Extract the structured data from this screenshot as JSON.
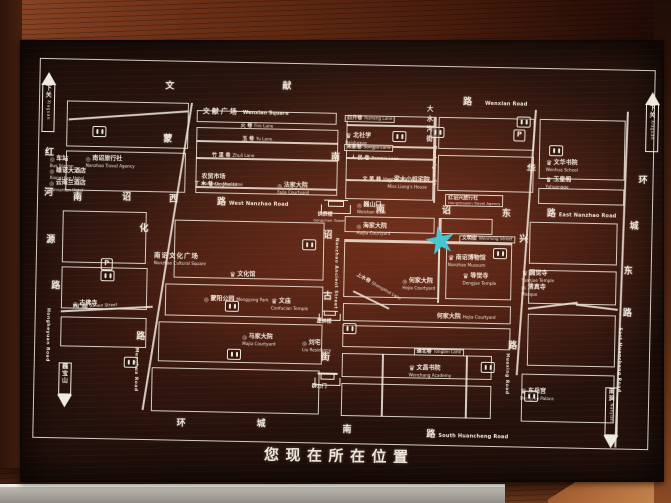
{
  "banner": {
    "text": "您现在所在位置"
  },
  "colors": {
    "star": "#38cadc",
    "line": "#f2ece0",
    "board": "#23110c",
    "frame": "#6b2f15"
  },
  "icons": {
    "parking": "P",
    "crown": "♛",
    "circle": "◎"
  },
  "map": {
    "roads": [
      {
        "t": "rc",
        "x": 130,
        "y": 28,
        "cn": "文"
      },
      {
        "t": "rc",
        "x": 247,
        "y": 26,
        "cn": "献"
      },
      {
        "t": "rc",
        "x": 428,
        "y": 38,
        "cn": "路"
      },
      {
        "t": "en",
        "x": 450,
        "y": 41,
        "en": "Wenxian Road",
        "id": "wenxian-road"
      },
      {
        "t": "rc",
        "x": 40,
        "y": 141,
        "cn": "南"
      },
      {
        "t": "rc",
        "x": 89,
        "y": 140,
        "cn": "诏"
      },
      {
        "t": "rc",
        "x": 136,
        "y": 141,
        "cn": "西"
      },
      {
        "t": "rc",
        "x": 184,
        "y": 143,
        "cn": "路"
      },
      {
        "t": "en",
        "x": 196,
        "y": 146,
        "en": "West Nanzhao Road",
        "id": "west-nanzhao-road"
      },
      {
        "t": "rc",
        "x": 343,
        "y": 147,
        "cn": "南"
      },
      {
        "t": "rc",
        "x": 409,
        "y": 147,
        "cn": "诏"
      },
      {
        "t": "rc",
        "x": 469,
        "y": 149,
        "cn": "东"
      },
      {
        "t": "rc",
        "x": 514,
        "y": 148,
        "cn": "路"
      },
      {
        "t": "en",
        "x": 526,
        "y": 151,
        "en": "East Nanzhao Road",
        "id": "east-nanzhao-road"
      },
      {
        "t": "rc",
        "x": 148,
        "y": 365,
        "cn": "环"
      },
      {
        "t": "rc",
        "x": 228,
        "y": 364,
        "cn": "城"
      },
      {
        "t": "rc",
        "x": 314,
        "y": 368,
        "cn": "南"
      },
      {
        "t": "rc",
        "x": 398,
        "y": 371,
        "cn": "路"
      },
      {
        "t": "en",
        "x": 410,
        "y": 374,
        "en": "South Huancheng Road",
        "id": "south-huancheng-road"
      },
      {
        "t": "rc",
        "x": 11,
        "y": 97,
        "cn": "红"
      },
      {
        "t": "rc",
        "x": 11,
        "y": 137,
        "cn": "河"
      },
      {
        "t": "rc",
        "x": 14,
        "y": 184,
        "cn": "源"
      },
      {
        "t": "rc",
        "x": 20,
        "y": 230,
        "cn": "路"
      },
      {
        "t": "ven",
        "x": 14,
        "y": 256,
        "en": "Hongheyuan Road",
        "id": "hongheyuan-road"
      },
      {
        "t": "rc",
        "x": 129,
        "y": 81,
        "cn": "蒙"
      },
      {
        "t": "rc",
        "x": 107,
        "y": 171,
        "cn": "化"
      },
      {
        "t": "rc",
        "x": 106,
        "y": 279,
        "cn": "路"
      },
      {
        "t": "ven",
        "x": 103,
        "y": 294,
        "en": "Menghua Road",
        "id": "menghua-road"
      },
      {
        "t": "rc",
        "x": 297,
        "y": 96,
        "cn": "南"
      },
      {
        "t": "rc",
        "x": 291,
        "y": 174,
        "cn": "诏"
      },
      {
        "t": "rc",
        "x": 292,
        "y": 235,
        "cn": "古"
      },
      {
        "t": "rc",
        "x": 291,
        "y": 296,
        "cn": "街"
      },
      {
        "t": "ven",
        "x": 301,
        "y": 180,
        "en": "Nanzhao Ancient Street",
        "id": "nanzhao-ancient-street"
      },
      {
        "t": "rc",
        "x": 493,
        "y": 104,
        "cn": "华"
      },
      {
        "t": "rc",
        "x": 487,
        "y": 174,
        "cn": "兴"
      },
      {
        "t": "rc",
        "x": 478,
        "y": 281,
        "cn": "路"
      },
      {
        "t": "ven",
        "x": 474,
        "y": 292,
        "en": "Huaxing Road",
        "id": "huaxing-road"
      },
      {
        "t": "rc",
        "x": 605,
        "y": 113,
        "cn": "环"
      },
      {
        "t": "rc",
        "x": 597,
        "y": 159,
        "cn": "城"
      },
      {
        "t": "rc",
        "x": 592,
        "y": 204,
        "cn": "东"
      },
      {
        "t": "rc",
        "x": 592,
        "y": 246,
        "cn": "路"
      },
      {
        "t": "ven",
        "x": 586,
        "y": 264,
        "en": "East Huancheng Road",
        "id": "east-huancheng-road"
      },
      {
        "t": "rcs",
        "x": 392,
        "y": 46,
        "cn": "大"
      },
      {
        "t": "rcs",
        "x": 392,
        "y": 56,
        "cn": "水"
      },
      {
        "t": "rcs",
        "x": 392,
        "y": 66,
        "cn": "沟"
      },
      {
        "t": "rcs",
        "x": 392,
        "y": 76,
        "cn": "街"
      },
      {
        "t": "ven",
        "x": 397,
        "y": 86,
        "en": "Dashuigou St",
        "id": "dashuigou-street"
      }
    ],
    "areas": [
      {
        "t": "sq",
        "x": 168,
        "y": 45,
        "cn": "文献广场",
        "en": "Wenxian Square",
        "id": "wenxian-square"
      },
      {
        "t": "lm",
        "x": 122,
        "y": 190,
        "cn": "南诏文化广场",
        "en": "Nanzhao Cultural Square",
        "big": 1,
        "id": "nanzhao-cultural-square"
      }
    ],
    "legend": [
      {
        "t": "lm",
        "icon": "c",
        "x": 16,
        "y": 95,
        "cn": "车站",
        "en": "Bus Station",
        "id": "legend-bus-station"
      },
      {
        "t": "lm",
        "icon": "c",
        "x": 52,
        "y": 94,
        "cn": "南诏旅行社",
        "en": "Nanzhao Travel Agency",
        "id": "legend-nanzhao-travel-agency"
      },
      {
        "t": "lm",
        "icon": "c",
        "x": 16,
        "y": 107,
        "cn": "雄诏大酒店",
        "en": "Xiongzhao Hotel",
        "id": "legend-xiongzhao-hotel"
      },
      {
        "t": "lm",
        "icon": "c",
        "x": 16,
        "y": 119,
        "cn": "云南兰酒店",
        "en": "Yunnanlan Hotel",
        "id": "legend-yunnanlan-hotel"
      }
    ],
    "landmarks": [
      {
        "t": "lm",
        "icon": "k",
        "x": 311,
        "y": 66,
        "cn": "北社学",
        "en": "Beishexue",
        "id": "beishexue"
      },
      {
        "t": "lm",
        "icon": "k",
        "x": 512,
        "y": 89,
        "cn": "文华书院",
        "en": "Wenhua School",
        "id": "wenhua-academy"
      },
      {
        "t": "lm",
        "icon": "k",
        "x": 512,
        "y": 106,
        "cn": "玉皇阁",
        "en": "Yuhuangge",
        "id": "yuhuangge"
      },
      {
        "t": "lm",
        "icon": "c",
        "x": 354,
        "y": 109,
        "cn": "梁大小姐宅院",
        "en": "Miss Liang's House",
        "id": "miss-liang-house"
      },
      {
        "t": "lm",
        "x": 168,
        "y": 110,
        "cn": "农贸市场",
        "en": "Nongmao Market",
        "id": "nongmao-market"
      },
      {
        "t": "lm",
        "icon": "c",
        "x": 244,
        "y": 117,
        "cn": "法家大院",
        "en": "Fajia Courtyard",
        "id": "fajia-courtyard"
      },
      {
        "t": "lm",
        "icon": "c",
        "x": 324,
        "y": 135,
        "cn": "巍山门",
        "en": "Weishan Gate",
        "id": "weishan-gate"
      },
      {
        "t": "box2",
        "x": 412,
        "y": 134,
        "cn": "红诏兴旅行社",
        "en": "Hongzhaoxin Travel Agency",
        "id": "hongzhaoxin-travel-agency"
      },
      {
        "t": "lm",
        "icon": "c",
        "x": 324,
        "y": 156,
        "cn": "海家大院",
        "en": "Haijia Courtyard",
        "id": "haijia-courtyard"
      },
      {
        "t": "lm",
        "icon": "k",
        "x": 416,
        "y": 186,
        "cn": "南诏博物馆",
        "en": "Nanzhao Museum",
        "id": "nanzhao-museum"
      },
      {
        "t": "lm",
        "icon": "k",
        "x": 431,
        "y": 204,
        "cn": "等觉寺",
        "en": "Dengjue Temple",
        "id": "dengjue-temple"
      },
      {
        "t": "lm",
        "icon": "c",
        "x": 371,
        "y": 210,
        "cn": "何家大院",
        "en": "Hejia Courtyard",
        "id": "hejia-courtyard-1"
      },
      {
        "t": "lm",
        "x": 406,
        "y": 245,
        "cn": "何家大院",
        "en": "Hejia Courtyard",
        "inline": 1,
        "id": "hejia-courtyard-2"
      },
      {
        "t": "lm",
        "icon": "c",
        "x": 272,
        "y": 274,
        "cn": "刘宅",
        "en": "Liu Residence",
        "id": "liu-residence"
      },
      {
        "t": "lm",
        "icon": "k",
        "x": 490,
        "y": 200,
        "cn": "圆觉寺",
        "en": "Yuanjue Temple",
        "id": "yuanjue-temple"
      },
      {
        "t": "lm",
        "icon": "c",
        "x": 490,
        "y": 214,
        "cn": "清真寺",
        "en": "Mosque",
        "id": "mosque"
      },
      {
        "t": "lm",
        "icon": "k",
        "x": 198,
        "y": 207,
        "cn": "文化馆",
        "en": "",
        "id": "culture-hall"
      },
      {
        "t": "lm",
        "icon": "c",
        "x": 173,
        "y": 232,
        "cn": "蒙阳公园",
        "en": "Mengyang Park",
        "inline": 1,
        "id": "mengyang-park"
      },
      {
        "t": "lm",
        "icon": "k",
        "x": 240,
        "y": 233,
        "cn": "文庙",
        "en": "Confucian Temple",
        "id": "confucian-temple"
      },
      {
        "t": "lm",
        "icon": "c",
        "x": 212,
        "y": 269,
        "cn": "马家大院",
        "en": "Majia Courtyard",
        "id": "majia-courtyard"
      },
      {
        "t": "lm",
        "icon": "c",
        "x": 42,
        "y": 239,
        "cn": "古佛寺",
        "en": "",
        "id": "gufo-temple"
      },
      {
        "t": "lm",
        "icon": "k",
        "x": 379,
        "y": 297,
        "cn": "文昌书院",
        "en": "Wenchang Academy",
        "id": "wenchang-academy"
      },
      {
        "t": "lm",
        "icon": "k",
        "x": 491,
        "y": 318,
        "cn": "东岳宫",
        "en": "Dongyue Palace",
        "id": "dongyue-palace"
      }
    ],
    "lanes": [
      {
        "t": "lane",
        "box": 1,
        "x": 310,
        "y": 57,
        "cn": "日升巷",
        "en": "Risheng Lane",
        "id": "risheng-lane"
      },
      {
        "t": "lane",
        "box": 1,
        "x": 310,
        "y": 86,
        "cn": "宋家巷",
        "en": "Songjia Lane",
        "id": "songjia-lane"
      },
      {
        "t": "lane",
        "x": 317,
        "y": 98,
        "cn": "人 民 巷",
        "en": "Renmin Lane",
        "id": "renmin-lane"
      },
      {
        "t": "lane",
        "x": 329,
        "y": 119,
        "cn": "文 笔 巷",
        "en": "Wenbi Lane",
        "id": "wenbi-lane"
      },
      {
        "t": "lane",
        "x": 206,
        "y": 68,
        "cn": "火 巷",
        "en": "Fire Lane",
        "id": "fire-lane"
      },
      {
        "t": "lane",
        "x": 208,
        "y": 81,
        "cn": "玉 巷",
        "en": "Yu Lane",
        "id": "yu-lane"
      },
      {
        "t": "lane",
        "x": 178,
        "y": 98,
        "cn": "竹 里 巷",
        "en": "Zhuli Lane",
        "id": "zhuli-lane"
      },
      {
        "t": "lane",
        "x": 161,
        "y": 127,
        "cn": "丁 木 巷",
        "en": "Dingmu Lane",
        "id": "dingmu-lane"
      },
      {
        "t": "lane",
        "box": 1,
        "x": 427,
        "y": 175,
        "cn": "文明街",
        "en": "Wenming Street",
        "id": "wenming-street"
      },
      {
        "t": "lane",
        "x": 322,
        "y": 226,
        "cn": "上水巷",
        "en": "Shangshui Lane",
        "rot": 28,
        "id": "shangshui-lane"
      },
      {
        "t": "lane",
        "box": 1,
        "x": 384,
        "y": 289,
        "cn": "通北巷",
        "en": "Tongbei Lane",
        "id": "tongbei-lane"
      },
      {
        "t": "lane",
        "x": 42,
        "y": 251,
        "cn": "西门街",
        "en": "Ximen Street",
        "rot": -4,
        "id": "ximen-street"
      }
    ],
    "gates": [
      {
        "t": "gate",
        "x": 288,
        "y": 137,
        "w": 28,
        "h": 18,
        "cn": "拱辰楼",
        "en": "Gongchen Tower",
        "id": "gongchen-tower"
      },
      {
        "t": "gate",
        "x": 288,
        "y": 249,
        "w": 20,
        "h": 13,
        "cn": "星拱楼",
        "en": "",
        "id": "xinggong-tower"
      },
      {
        "t": "gate",
        "x": 285,
        "y": 311,
        "w": 24,
        "h": 16,
        "cn": "群力门",
        "en": "",
        "id": "qunli-gate"
      }
    ],
    "facilities": [
      {
        "t": "wc",
        "x": 58,
        "y": 73
      },
      {
        "t": "wc",
        "x": 358,
        "y": 72
      },
      {
        "t": "wc",
        "x": 396,
        "y": 67
      },
      {
        "t": "wc",
        "x": 482,
        "y": 55
      },
      {
        "t": "wc",
        "x": 515,
        "y": 83
      },
      {
        "t": "wc",
        "x": 270,
        "y": 182
      },
      {
        "t": "wc",
        "x": 69,
        "y": 217
      },
      {
        "t": "wc",
        "x": 194,
        "y": 245
      },
      {
        "t": "wc",
        "x": 197,
        "y": 293
      },
      {
        "t": "wc",
        "x": 94,
        "y": 303
      },
      {
        "t": "wc",
        "x": 312,
        "y": 265
      },
      {
        "t": "wc",
        "x": 461,
        "y": 187
      },
      {
        "t": "wc",
        "x": 451,
        "y": 301
      },
      {
        "t": "wc",
        "x": 495,
        "y": 329
      },
      {
        "t": "p",
        "x": 479,
        "y": 68
      },
      {
        "t": "p",
        "x": 69,
        "y": 205
      }
    ],
    "arrows": [
      {
        "t": "arr",
        "dir": "up",
        "x": 6,
        "y": 20,
        "cn": "下关",
        "en": "Xiaguan",
        "id": "arrow-xiaguan-west"
      },
      {
        "t": "arr",
        "dir": "up",
        "x": 610,
        "y": 28,
        "cn": "下关",
        "en": "Xiaguan",
        "id": "arrow-xiaguan-east"
      },
      {
        "t": "arr",
        "dir": "down",
        "x": 28,
        "y": 310,
        "cn": "巍宝山",
        "en": "",
        "id": "arrow-weibaoshan"
      },
      {
        "t": "arr",
        "dir": "down",
        "x": 575,
        "y": 324,
        "cn": "南涧",
        "en": "Nanjian",
        "id": "arrow-nanjian"
      }
    ],
    "marker": {
      "t": "star",
      "x": 393,
      "y": 166,
      "s": 30,
      "id": "you-are-here-star"
    }
  }
}
